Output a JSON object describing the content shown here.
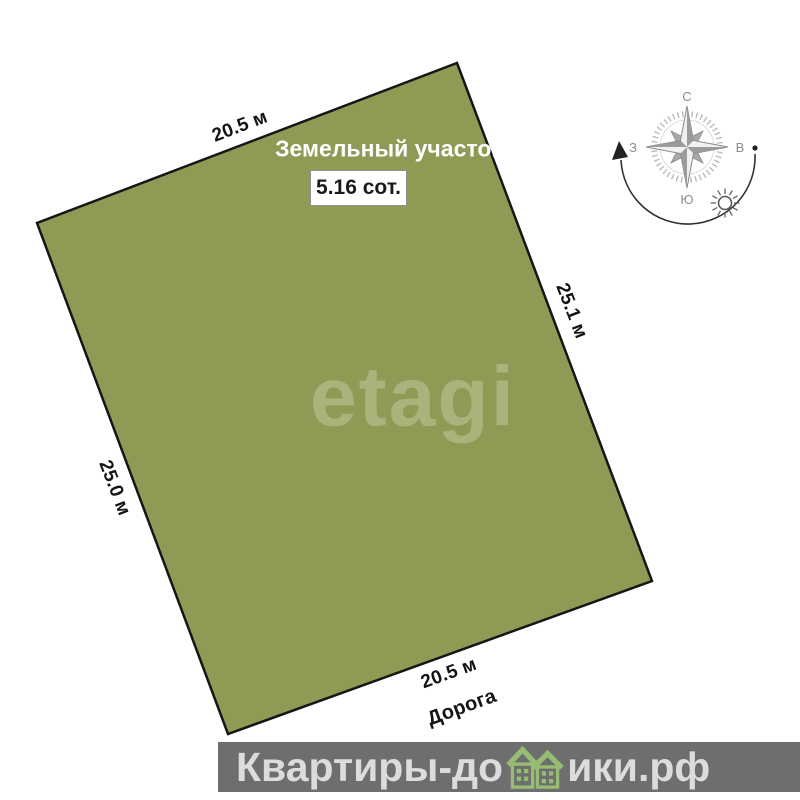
{
  "plot": {
    "title": "Земельный участок",
    "area_label": "5.16 сот.",
    "fill_color": "#8e9b54",
    "outline_color": "#161616",
    "dimensions": {
      "top": "20.5 м",
      "right": "25.1 м",
      "bottom": "20.5 м",
      "left": "25.0 м"
    },
    "road_label": "Дорога"
  },
  "compass": {
    "north": "С",
    "south": "Ю",
    "west": "З",
    "east": "В"
  },
  "watermark_center": "etagi",
  "footer": {
    "text_before_houses": "Квартиры-до",
    "text_after_houses": "ики.рф",
    "band_color": "#6e6e6e",
    "text_color": "#dcdcdc",
    "house_icon_color": "#96bd73"
  }
}
